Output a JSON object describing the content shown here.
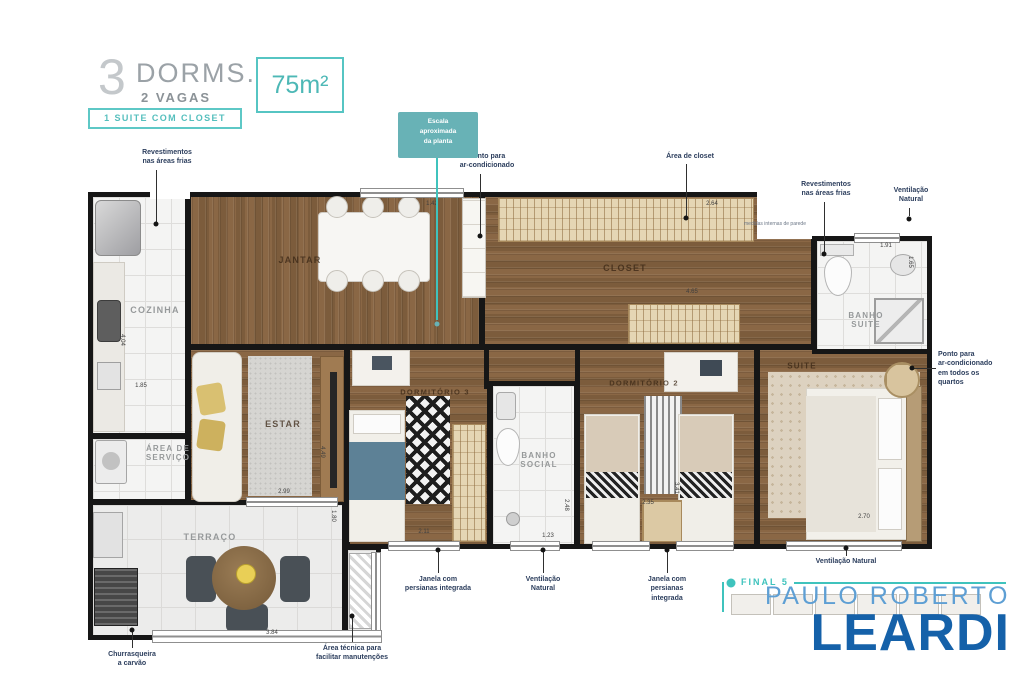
{
  "header": {
    "num": "3",
    "dorms": "DORMS.",
    "vagas": "2 VAGAS",
    "badge": "1 SUITE COM CLOSET",
    "area": "75m²"
  },
  "callout": {
    "text": "Escala\naproximada\nda planta"
  },
  "rooms": {
    "cozinha": "COZINHA",
    "jantar": "JANTAR",
    "closet": "CLOSET",
    "banho_suite": "BANHO\nSUITE",
    "estar": "ESTAR",
    "dorm3": "DORMITÓRIO 3",
    "banho_social": "BANHO\nSOCIAL",
    "dorm2": "DORMITÓRIO 2",
    "suite": "SUITE",
    "area_servico": "ÁREA DE\nSERVIÇO",
    "terraco": "TERRAÇO"
  },
  "annotations": [
    "Revestimentos\nnas áreas frias",
    "Ponto para\nar-condicionado",
    "Área de closet",
    "Revestimentos\nnas áreas frias",
    "Ventilação\nNatural",
    "Ponto para\nar-condicionado\nem todos os\nquartos",
    "Ventilação Natural",
    "Janela com\npersianas integrada",
    "Ventilação\nNatural",
    "Janela com\npersianas\nintegrada",
    "Churrasqueira\na carvão",
    "Área técnica para\nfacilitar manutenções"
  ],
  "fine_print": "medidas internas de parede",
  "dims": [
    "1.42",
    "2.64",
    "1.91",
    "1.65",
    "4.65",
    "4.04",
    "1.85",
    "2.99",
    "4.49",
    "1.80",
    "2.11",
    "1.23",
    "2.48",
    "2.35",
    "3.41",
    "2.70",
    "3.84"
  ],
  "keyplan": {
    "final": "FINAL 5"
  },
  "logo": {
    "top": "PAULO ROBERTO",
    "main": "LEARDI"
  },
  "colors": {
    "teal": "#56c5c3",
    "navy": "#2c3e5d",
    "logo_blue": "#1561a9",
    "logo_light": "#5e9fd4",
    "wall": "#161616"
  }
}
